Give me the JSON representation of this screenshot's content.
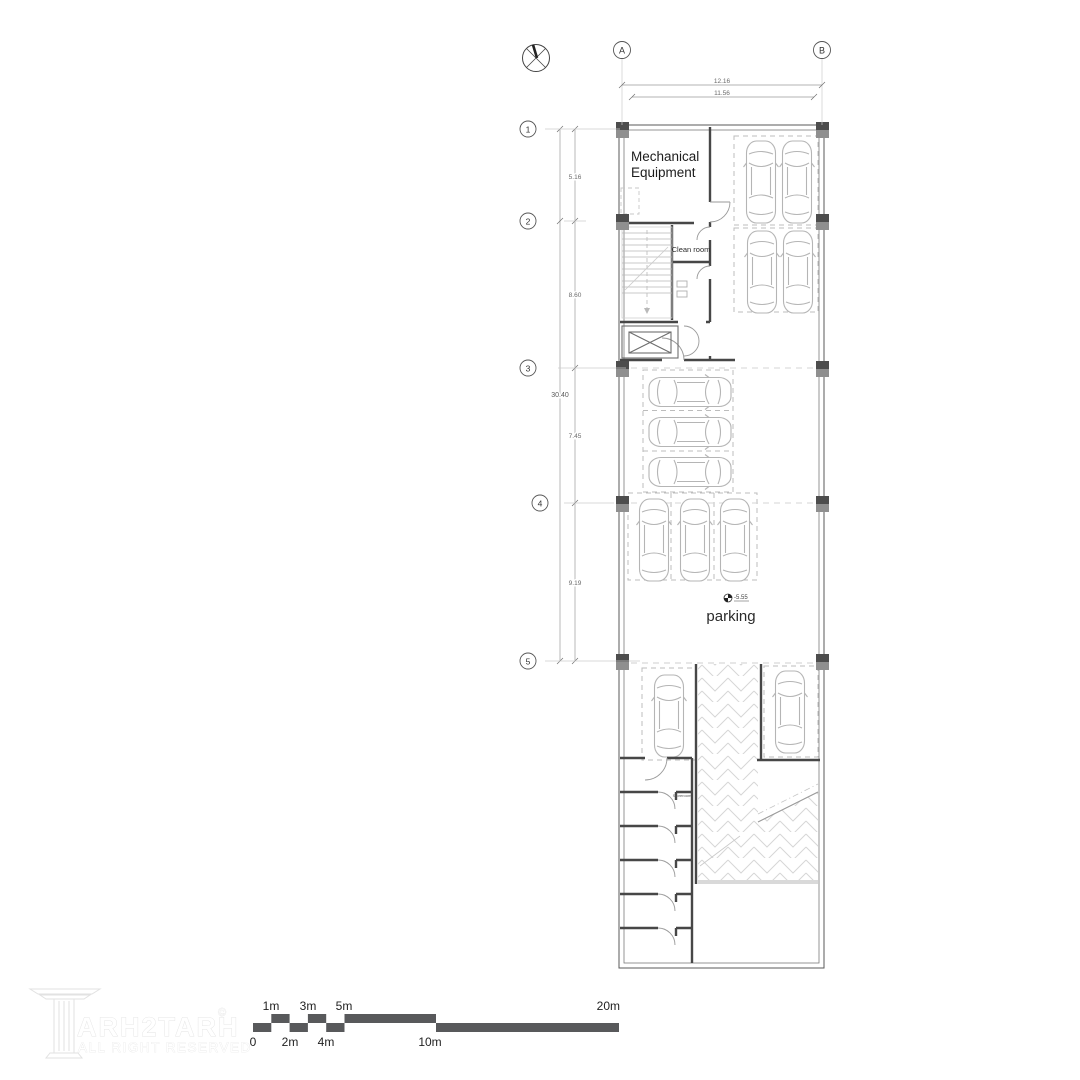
{
  "plan": {
    "type": "architectural-floor-plan",
    "rooms": {
      "mechanical_line1": "Mechanical",
      "mechanical_line2": "Equipment",
      "clean_room": "Clean room",
      "parking": "parking",
      "storeroom": "Storeroom"
    },
    "grid": {
      "top_bubbles": {
        "a": "A",
        "b": "B"
      },
      "left_bubbles": {
        "r1": "1",
        "r2": "2",
        "r3": "3",
        "r4": "4",
        "r5": "5"
      }
    },
    "dims": {
      "top_outer": "12.16",
      "top_inner": "11.56",
      "left_total": "30.40",
      "seg_1_2": "5.16",
      "seg_2_3": "8.60",
      "seg_3_4": "7.45",
      "seg_4_5": "9.19"
    },
    "elevation": "-5.55",
    "car_count": 13
  },
  "scalebar": {
    "l0": "0",
    "l1": "1m",
    "l2": "2m",
    "l3": "3m",
    "l4": "4m",
    "l5": "5m",
    "l10": "10m",
    "l20": "20m"
  },
  "watermark": {
    "brand": "ARH2TARH",
    "copyright": "©",
    "tagline": "ALL RIGHT RESERVED"
  },
  "colors": {
    "wall": "#474747",
    "outer_wall": "#5a5a5a",
    "column_dark": "#4d4d4d",
    "column_mid": "#8f8f8f",
    "dashed_stall": "#bcbcbc",
    "car_line": "#b5b5b5",
    "dim_line": "#9a9a9a",
    "hatch": "#d6d6d6",
    "scalebar_fill": "#58595b",
    "text_dark": "#1c1c1c"
  }
}
